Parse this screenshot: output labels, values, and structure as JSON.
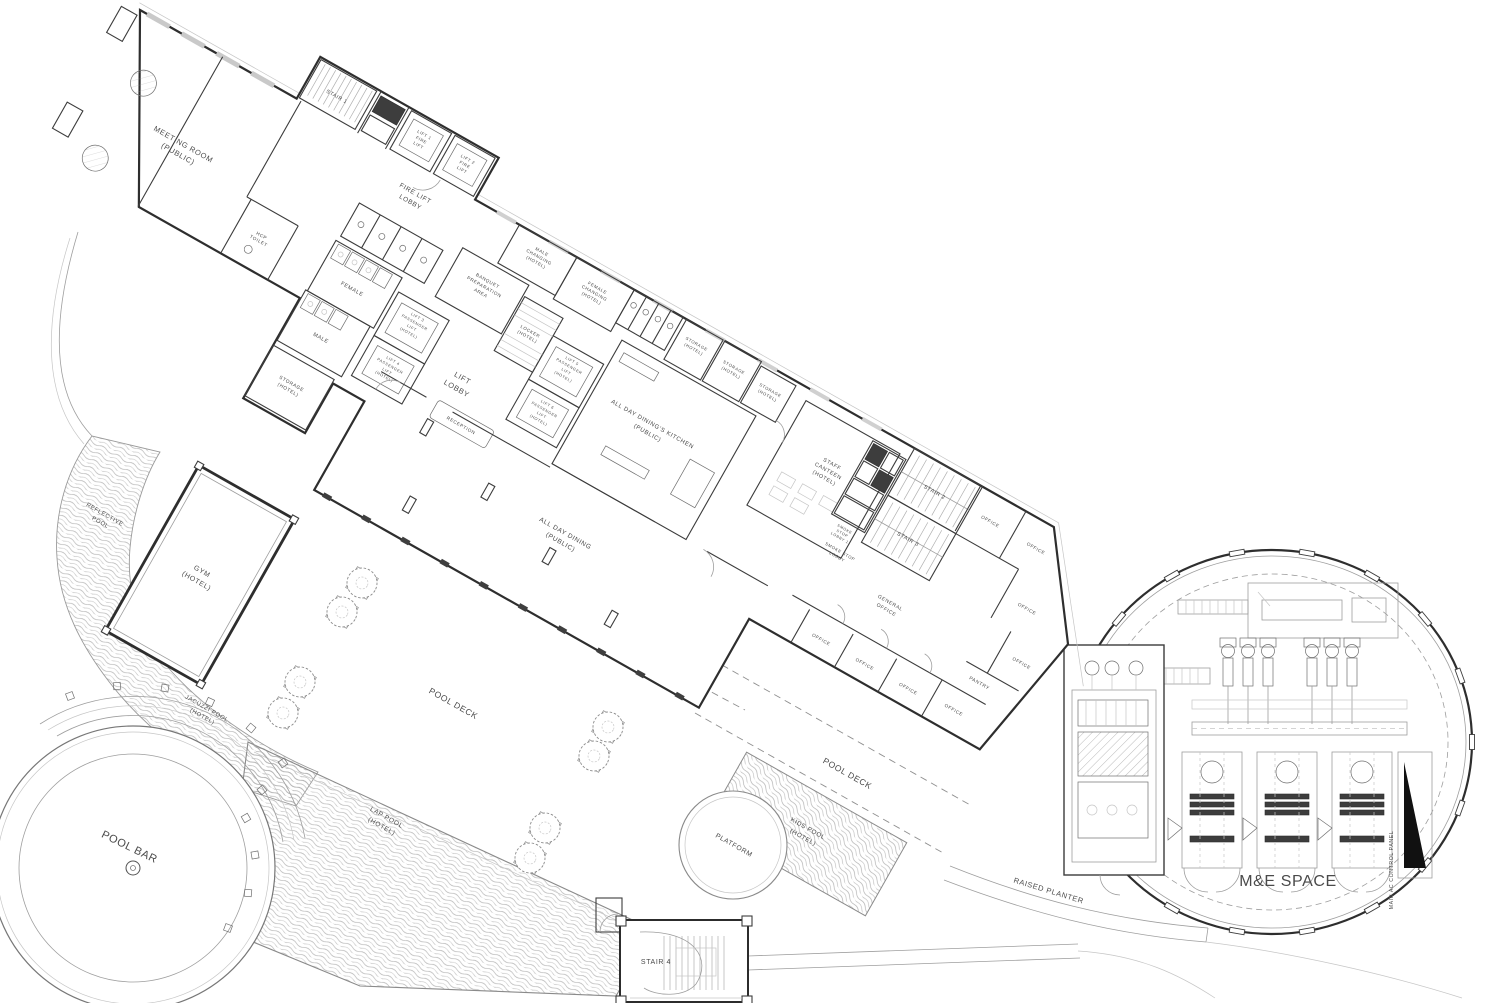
{
  "drawing": {
    "type": "hotel level floor plan",
    "colors": {
      "ink": "#2e2e2e",
      "light_line": "#9e9e9e",
      "water_line": "#b0b0b0",
      "text": "#4a4a4a",
      "shaft_fill": "#3d3d3d",
      "panel_fill": "#111111"
    }
  },
  "rooms": {
    "meeting_room": [
      "MEETING ROOM",
      "(PUBLIC)"
    ],
    "stair_1": "STAIR 1",
    "lift_1": [
      "LIFT 1",
      "FIRE",
      "LIFT"
    ],
    "lift_2": [
      "LIFT 2",
      "FIRE",
      "LIFT"
    ],
    "fire_lift_lobby": [
      "FIRE LIFT",
      "LOBBY"
    ],
    "hcp_toilet": [
      "HCP",
      "TOILET"
    ],
    "female": "FEMALE",
    "male": "MALE",
    "storage": [
      "STORAGE",
      "(HOTEL)"
    ],
    "lift_3": [
      "LIFT 3",
      "PASSENGER",
      "LIFT",
      "(HOTEL)"
    ],
    "lift_4": [
      "LIFT 4",
      "PASSENGER",
      "LIFT",
      "(HOTEL)"
    ],
    "lift_lobby": [
      "LIFT",
      "LOBBY"
    ],
    "lift_5": [
      "LIFT 5",
      "PASSENGER",
      "LIFT",
      "(HOTEL)"
    ],
    "lift_6": [
      "LIFT 6",
      "PASSENGER",
      "LIFT",
      "(HOTEL)"
    ],
    "reception": "RECEPTION",
    "banquet": [
      "BANQUET",
      "PREPARATION",
      "AREA"
    ],
    "locker": [
      "LOCKER",
      "(HOTEL)"
    ],
    "male_changing": [
      "MALE",
      "CHANGING",
      "(HOTEL)"
    ],
    "female_changing": [
      "FEMALE",
      "CHANGING",
      "(HOTEL)"
    ],
    "kitchen": [
      "ALL DAY DINING'S KITCHEN",
      "(PUBLIC)"
    ],
    "staff_canteen": [
      "STAFF",
      "CANTEEN",
      "(HOTEL)"
    ],
    "all_day_dining": [
      "ALL DAY DINING",
      "(PUBLIC)"
    ],
    "smoke_stop_lobby_1": [
      "SMOKE",
      "STOP",
      "LOBBY 1"
    ],
    "smoke_stop_lobby": [
      "SMOKE STOP",
      "LOBBY"
    ],
    "stair_2": "STAIR 2",
    "stair_3": "STAIR 3",
    "general_office": [
      "GENERAL",
      "OFFICE"
    ],
    "office": "OFFICE",
    "pantry": "PANTRY",
    "gym": [
      "GYM",
      "(HOTEL)"
    ],
    "reflective_pool": [
      "REFLECTIVE",
      "POOL"
    ],
    "jacuzzi_pool": [
      "JACUZZI POOL",
      "(HOTEL)"
    ],
    "pool_deck": "POOL DECK",
    "pool_bar": "POOL BAR",
    "lap_pool": [
      "LAP POOL",
      "(HOTEL)"
    ],
    "kids_pool": [
      "KIDS POOL",
      "(HOTEL)"
    ],
    "platform": "PLATFORM",
    "raised_planter": "RAISED PLANTER",
    "me_space": "M&E SPACE",
    "main_ac_panel": "MAIN AC CONTROL PANEL",
    "stair_4": "STAIR 4"
  }
}
